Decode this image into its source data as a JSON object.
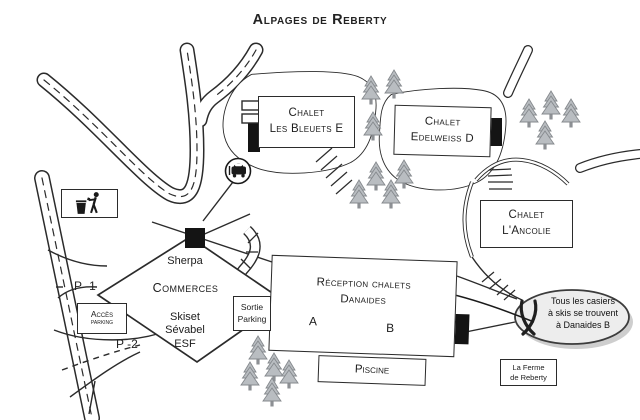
{
  "title": "Alpages de Reberty",
  "chalets": {
    "bleuets": {
      "line1": "Chalet",
      "line2": "Les Bleuets E"
    },
    "edelweiss": {
      "line1": "Chalet",
      "line2": "Edelweiss D"
    },
    "ancolie": {
      "line1": "Chalet",
      "line2": "L'Ancolie"
    }
  },
  "reception": {
    "line1": "Réception chalets",
    "line2": "Danaides",
    "wing_a": "A",
    "wing_b": "B"
  },
  "commerces": {
    "name": "Commerces",
    "shop_top": "Sherpa",
    "shop1": "Skiset",
    "shop2": "Sévabel",
    "shop3": "ESF"
  },
  "parking": {
    "access1": "Accès",
    "access2": "parking",
    "exit1": "Sortie",
    "exit2": "Parking",
    "p1": "P -1",
    "p2": "P -2"
  },
  "facilities": {
    "pool": "Piscine",
    "farm1": "La Ferme",
    "farm2": "de Reberty"
  },
  "note": {
    "line1": "Tous les casiers",
    "line2": "à skis se trouvent",
    "line3": "à Danaides B"
  },
  "icons": {
    "litter": "litter-disposal-icon",
    "car": "car-sign-icon",
    "skis": "crossed-skis-icon",
    "tree": "pine-tree-icon"
  },
  "colors": {
    "line": "#2b2b2b",
    "tree_fill": "#b9bdc1",
    "tree_stroke": "#85898d",
    "bubble_fill": "#ededed",
    "block": "#141414",
    "background": "#ffffff"
  }
}
